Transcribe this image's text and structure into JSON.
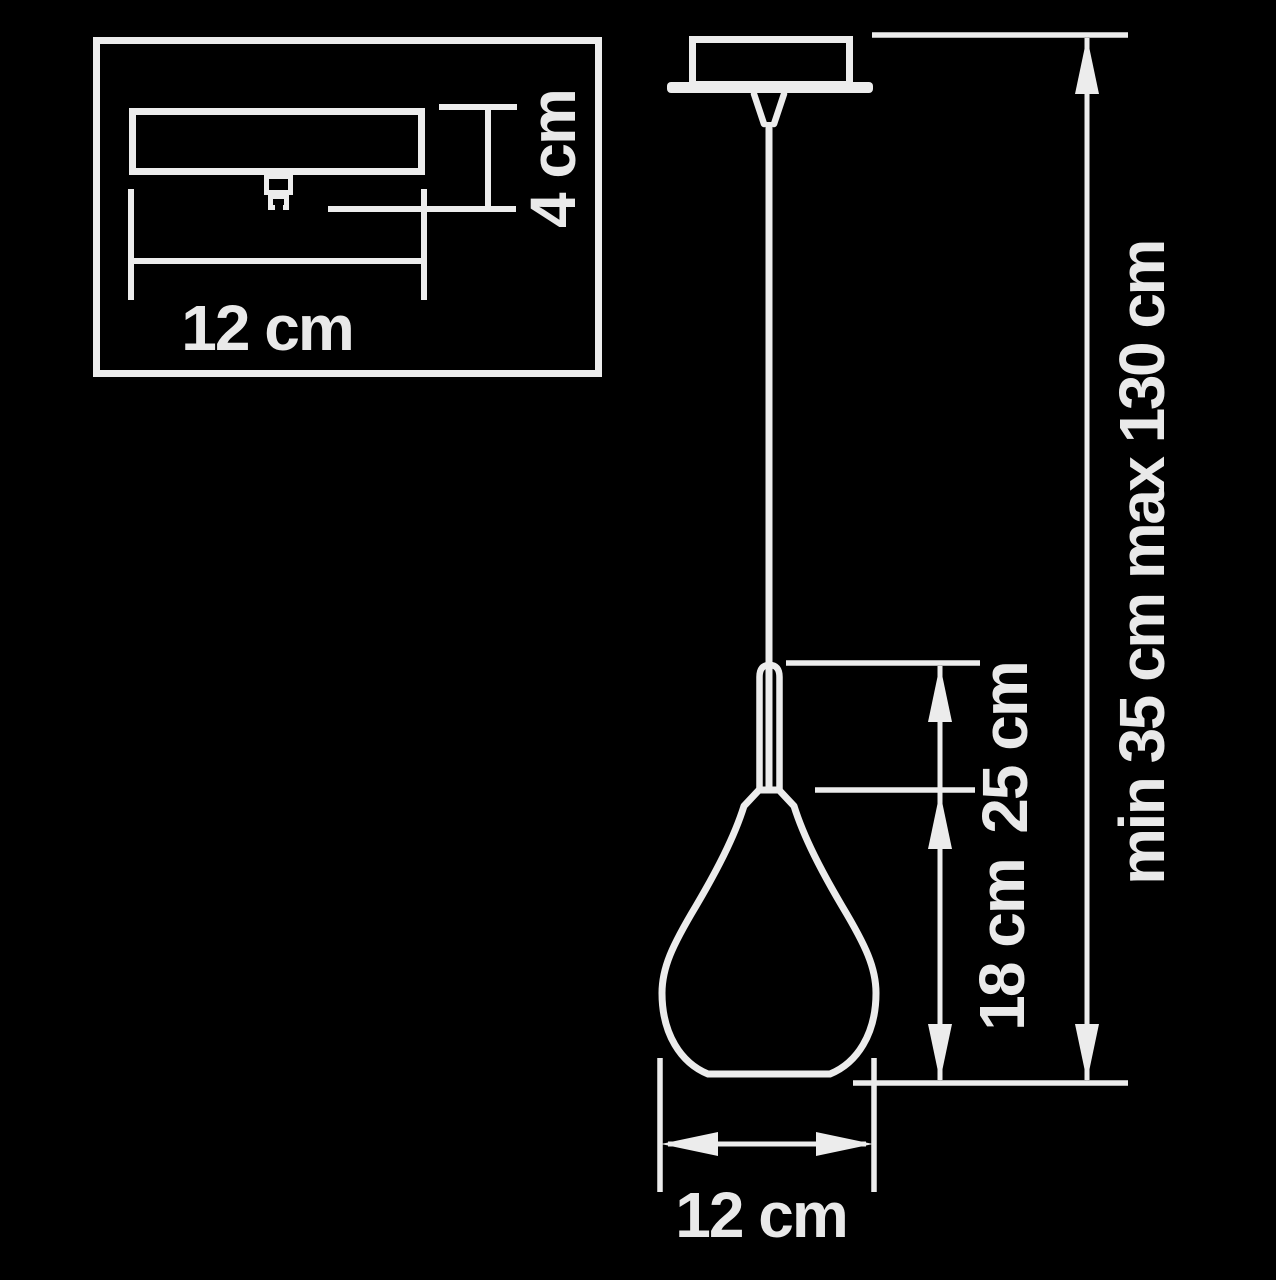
{
  "colors": {
    "background": "#000000",
    "line": "#ececec"
  },
  "inset": {
    "width_label": "12 cm",
    "height_label": "4 cm"
  },
  "main": {
    "shade_width_label": "12 cm",
    "shade_height_label": "18 cm",
    "suspension_to_bottom_label": "25 cm",
    "overall_height_label": "min 35 cm max 130 cm"
  }
}
